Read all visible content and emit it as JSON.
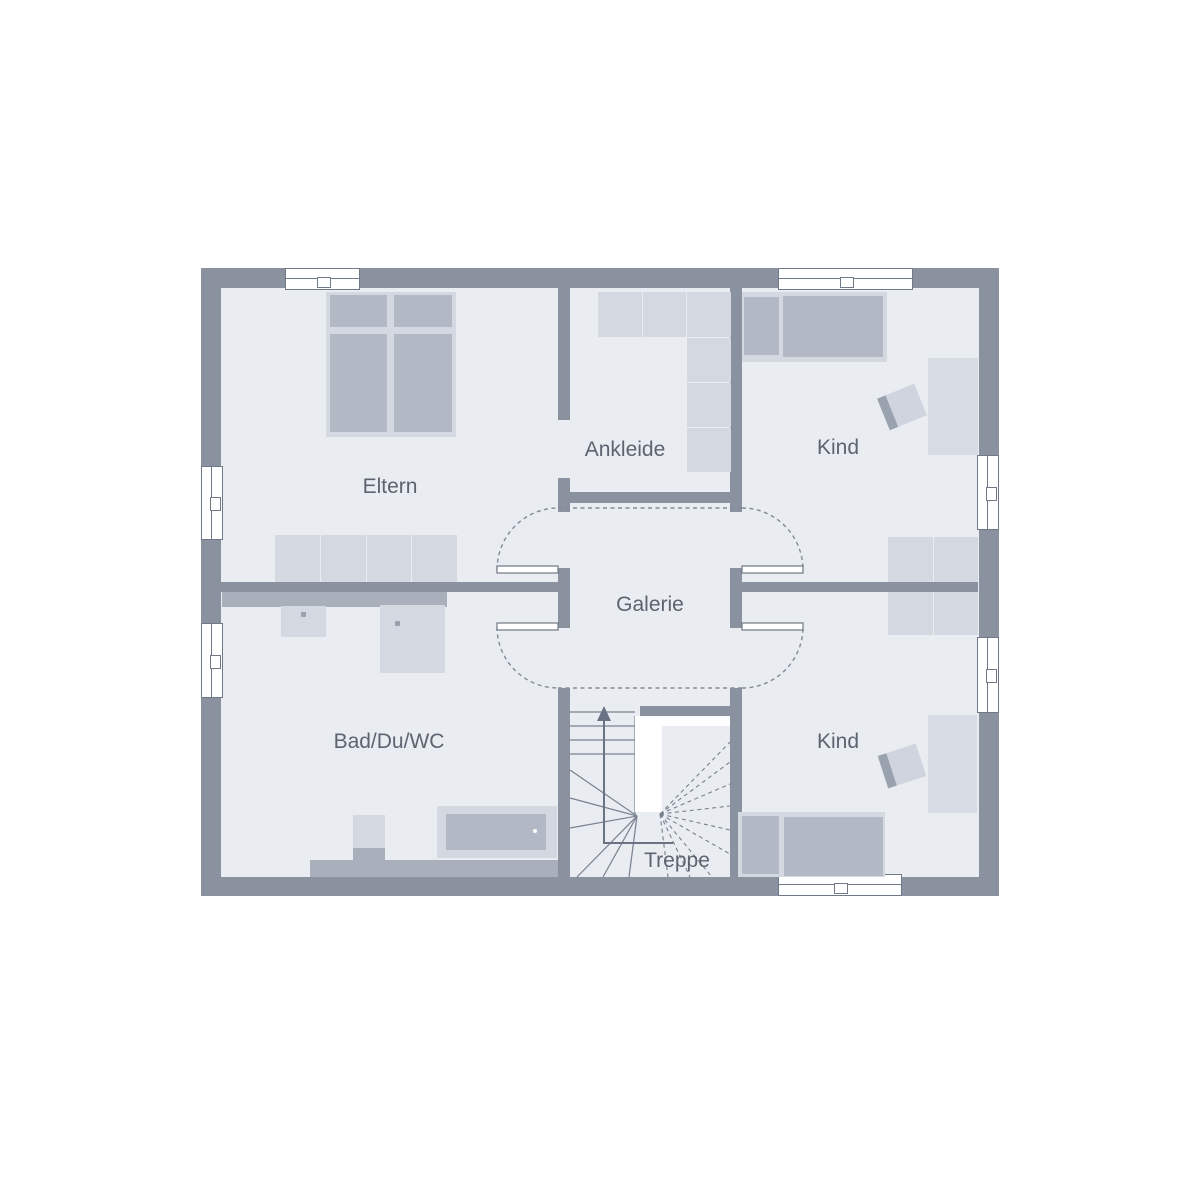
{
  "floorplan": {
    "rooms": [
      {
        "id": "eltern",
        "label": "Eltern"
      },
      {
        "id": "ankleide",
        "label": "Ankleide"
      },
      {
        "id": "kind-oben",
        "label": "Kind"
      },
      {
        "id": "galerie",
        "label": "Galerie"
      },
      {
        "id": "bad-du-wc",
        "label": "Bad/Du/WC"
      },
      {
        "id": "kind-unten",
        "label": "Kind"
      },
      {
        "id": "treppe",
        "label": "Treppe"
      }
    ],
    "stairs": {
      "direction_arrow": "up"
    },
    "colors": {
      "wall": "#8a92a0",
      "floor": "#e9ecf1",
      "furniture_light": "#d3d8e1",
      "furniture_mid": "#b2b8c4",
      "fixture_band": "#a9afbb",
      "outline": "#707988",
      "label_text": "#5c6470",
      "background": "#ffffff"
    }
  }
}
